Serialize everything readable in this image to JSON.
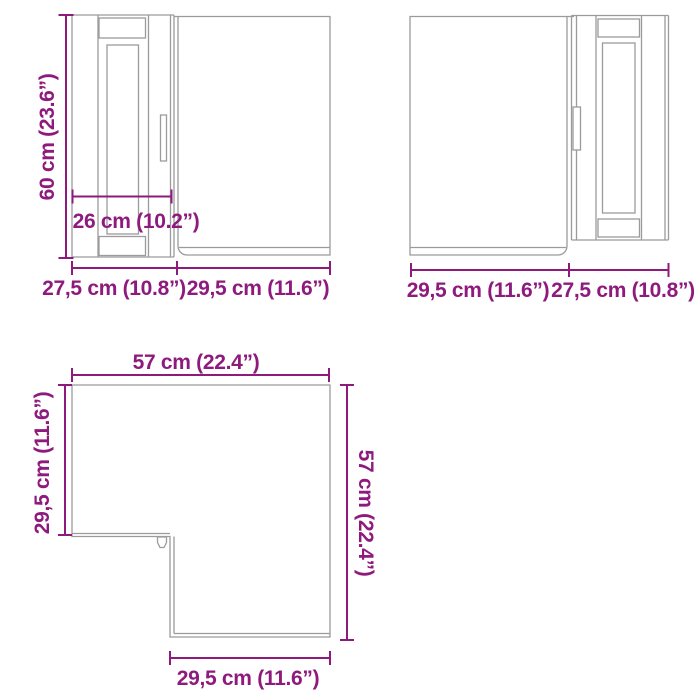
{
  "page": {
    "background": "#ffffff",
    "description_labels_only": true
  },
  "colors": {
    "dimension_accent": "#8e1a7d",
    "drawing_line": "#9b9b9b"
  },
  "cabinet_left": {
    "height": "60 cm (23.6”)",
    "door_width": "26 cm (10.2”)",
    "width_door_section": "27,5 cm (10.8”)",
    "width_side_section": "29,5 cm (11.6”)"
  },
  "cabinet_right": {
    "width_side_section": "29,5 cm (11.6”)",
    "width_door_section": "27,5 cm (10.8”)"
  },
  "top_view": {
    "top_width": "57 cm (22.4”)",
    "left_depth": "29,5 cm (11.6”)",
    "right_depth": "57 cm (22.4”)",
    "bottom_width": "29,5 cm (11.6”)"
  }
}
